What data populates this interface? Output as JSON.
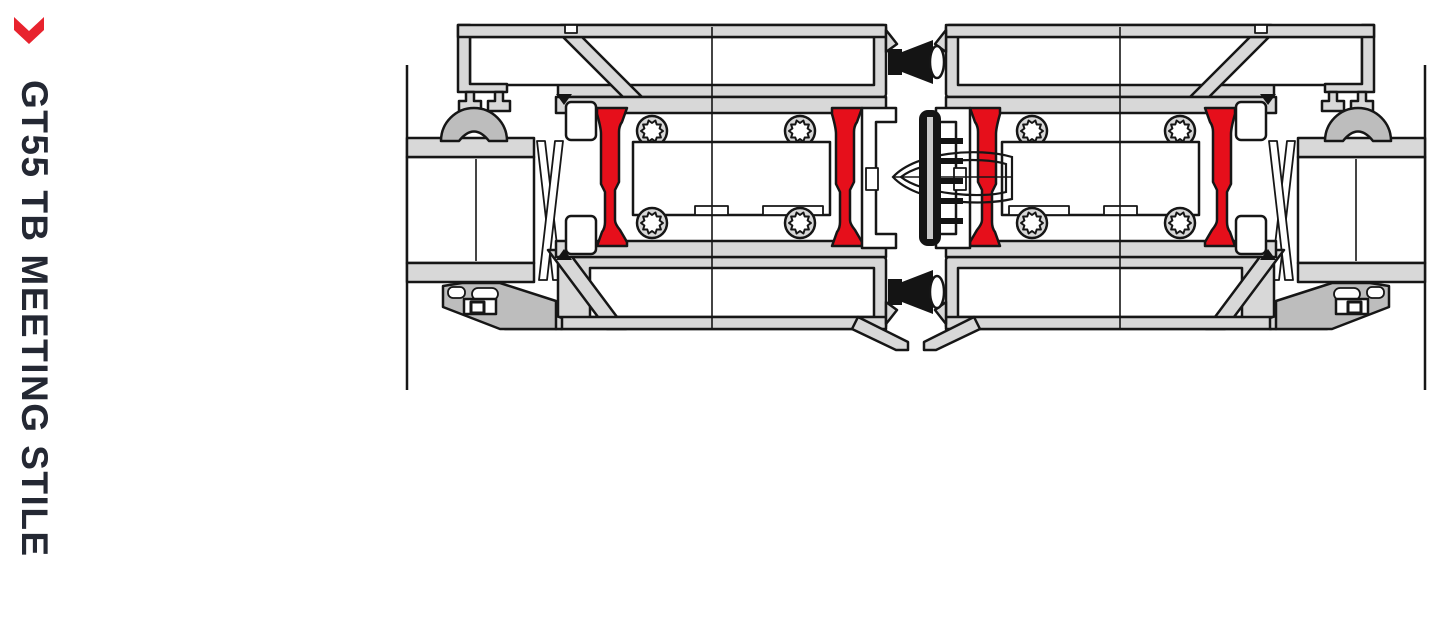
{
  "sidebar": {
    "title": "GT55 TB MEETING STILE",
    "title_color": "#242833",
    "chevron_icon_color": "#e8232e"
  },
  "diagram": {
    "name": "GT55 TB meeting stile cross-section",
    "type": "technical-section-drawing",
    "colors": {
      "aluminium": "#d8d8d8",
      "outline": "#161616",
      "thermal_break_red": "#e60f1b",
      "gasket_black": "#141414",
      "seal_gray": "#bdbdbd",
      "cavity_white": "#ffffff"
    },
    "parts": [
      "left sash profile",
      "right sash profile",
      "double glazing unit left",
      "double glazing unit right",
      "polyamide thermal breaks",
      "centre meeting gaskets",
      "glazing wedge gaskets",
      "glazing beads",
      "screw ports"
    ]
  }
}
